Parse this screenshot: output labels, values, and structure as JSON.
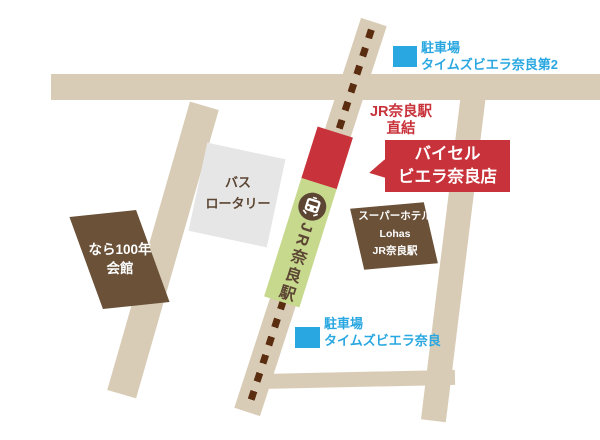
{
  "colors": {
    "road": "#D9CCB6",
    "dash": "#5B2D10",
    "red": "#C8323A",
    "green": "#C6D98D",
    "brown": "#6A5138",
    "gray": "#E6E6E6",
    "blue": "#29A7E0",
    "ink": "#5C4633"
  },
  "station": {
    "name": "JR奈良駅"
  },
  "direct_access": {
    "line1": "JR奈良駅",
    "line2": "直結"
  },
  "store_callout": {
    "line1": "バイセル",
    "line2": "ビエラ奈良店"
  },
  "parking_top": {
    "line1": "駐車場",
    "line2": "タイムズビエラ奈良第2"
  },
  "parking_bottom": {
    "line1": "駐車場",
    "line2": "タイムズビエラ奈良"
  },
  "bus_rotary": {
    "line1": "バス",
    "line2": "ロータリー"
  },
  "hotel": {
    "line1": "スーパーホテル",
    "line2": "Lohas",
    "line3": "JR奈良駅"
  },
  "hall": {
    "line1": "なら100年",
    "line2": "会館"
  }
}
